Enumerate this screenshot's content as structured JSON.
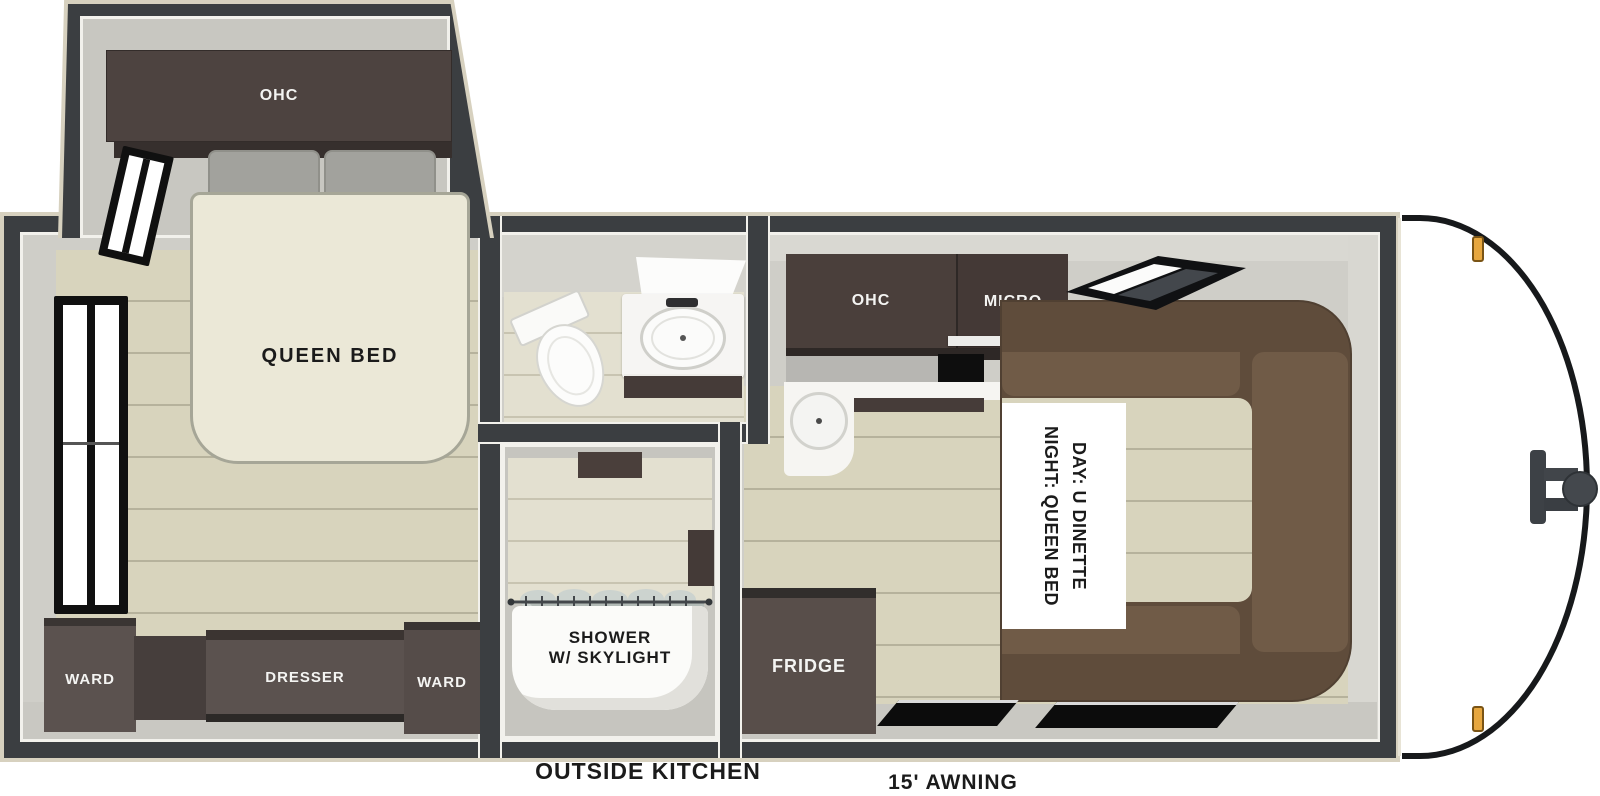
{
  "floorplan": {
    "bedroom": {
      "ohc": "OHC",
      "queen_bed": "QUEEN BED",
      "ward_left": "WARD",
      "dresser": "DRESSER",
      "ward_right": "WARD"
    },
    "bathroom": {
      "shower_line1": "SHOWER",
      "shower_line2": "W/ SKYLIGHT"
    },
    "kitchen": {
      "ohc": "OHC",
      "micro": "MICRO",
      "fridge": "FRIDGE"
    },
    "dinette": {
      "line1": "DAY: U DINETTE",
      "line2": "NIGHT: QUEEN BED"
    },
    "exterior": {
      "outside_kitchen": "OUTSIDE KITCHEN",
      "awning": "15' AWNING"
    },
    "colors": {
      "wall_dark": "#3b3e41",
      "outline_beige": "#d7d1bf",
      "interior_gray": "#cfcec8",
      "floor_plank": "#d8d4bd",
      "cabinet_brown": "#5b524f",
      "overhead_cabinet": "#4a3f3b",
      "dinette_brown": "#5f4c3b",
      "dinette_seat": "#705b47",
      "bed_cream": "#ebe8d7",
      "counter_white": "#f6f5f2",
      "marker_amber": "#e7a73f",
      "label_dark": "#1b1b1b",
      "label_light": "#f4f4f2"
    }
  }
}
